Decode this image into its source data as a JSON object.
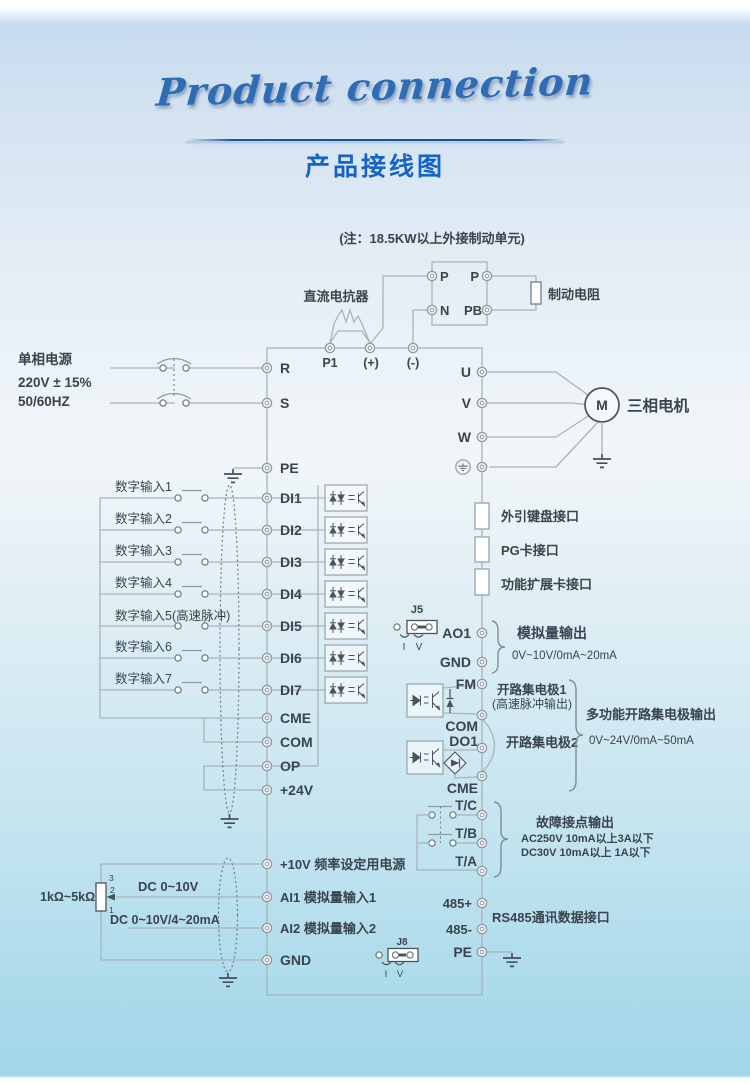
{
  "header": {
    "script_title": "Product connection",
    "title": "产品接线图"
  },
  "note": "(注：18.5KW以上外接制动单元)",
  "braking_unit": {
    "p_left": "P",
    "p_right": "P",
    "n": "N",
    "pb": "PB",
    "resistor": "制动电阻",
    "reactor": "直流电抗器"
  },
  "dc_bus": {
    "p1": "P1",
    "plus": "(+)",
    "minus": "(-)"
  },
  "power": {
    "line1": "单相电源",
    "line2": "220V ± 15%",
    "line3": "50/60HZ",
    "r": "R",
    "s": "S",
    "pe": "PE"
  },
  "digital_inputs": {
    "rows": [
      {
        "label": "数字输入1",
        "term": "DI1"
      },
      {
        "label": "数字输入2",
        "term": "DI2"
      },
      {
        "label": "数字输入3",
        "term": "DI3"
      },
      {
        "label": "数字输入4",
        "term": "DI4"
      },
      {
        "label": "数字输入5(高速脉冲)",
        "term": "DI5"
      },
      {
        "label": "数字输入6",
        "term": "DI6"
      },
      {
        "label": "数字输入7",
        "term": "DI7"
      }
    ],
    "cme": "CME",
    "com": "COM",
    "op": "OP",
    "v24": "+24V"
  },
  "analog_inputs": {
    "v10": "+10V 频率设定用电源",
    "ai1": "AI1 模拟量输入1",
    "ai2": "AI2 模拟量输入2",
    "gnd": "GND",
    "pot": "1kΩ~5kΩ",
    "pin3": "3",
    "pin2": "2",
    "pin1": "1",
    "ai1_signal": "DC 0~10V",
    "ai2_signal": "DC 0~10V/4~20mA"
  },
  "motor": {
    "u": "U",
    "v": "V",
    "w": "W",
    "m": "M",
    "label": "三相电机"
  },
  "interfaces": {
    "keypad": "外引键盘接口",
    "pg": "PG卡接口",
    "expansion": "功能扩展卡接口"
  },
  "analog_output": {
    "jumper": "J5",
    "pin_i": "I",
    "pin_v": "V",
    "ao1": "AO1",
    "gnd": "GND",
    "title": "模拟量输出",
    "range": "0V~10V/0mA~20mA"
  },
  "open_collector": {
    "fm": "FM",
    "oc1": "开路集电极1",
    "oc1_sub": "(高速脉冲输出)",
    "com": "COM",
    "do1": "DO1",
    "oc2": "开路集电极2",
    "cme": "CME",
    "title": "多功能开路集电极输出",
    "range": "0V~24V/0mA~50mA"
  },
  "relay": {
    "tc": "T/C",
    "tb": "T/B",
    "ta": "T/A",
    "title": "故障接点输出",
    "spec_ac": "AC250V 10mA以上3A以下",
    "spec_dc": "DC30V 10mA以上 1A以下"
  },
  "comm": {
    "p485": "485+",
    "n485": "485-",
    "pe": "PE",
    "title": "RS485通讯数据接口",
    "jumper": "J8",
    "pin_i": "I",
    "pin_v": "V"
  }
}
